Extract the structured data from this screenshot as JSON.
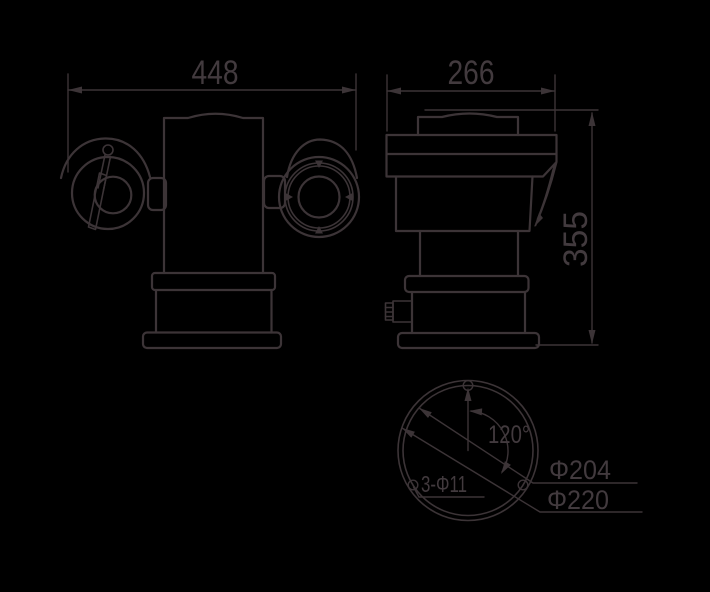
{
  "views": {
    "front": {
      "width_dim": "448"
    },
    "side": {
      "depth_dim": "266",
      "height_dim": "355"
    },
    "bottom": {
      "angle_dim": "120°",
      "bolt_circle_dim": "Φ204",
      "outer_circle_dim": "Φ220",
      "holes_dim": "3-Φ11"
    }
  },
  "colors": {
    "background": "#000000",
    "line": "#3c3437"
  }
}
